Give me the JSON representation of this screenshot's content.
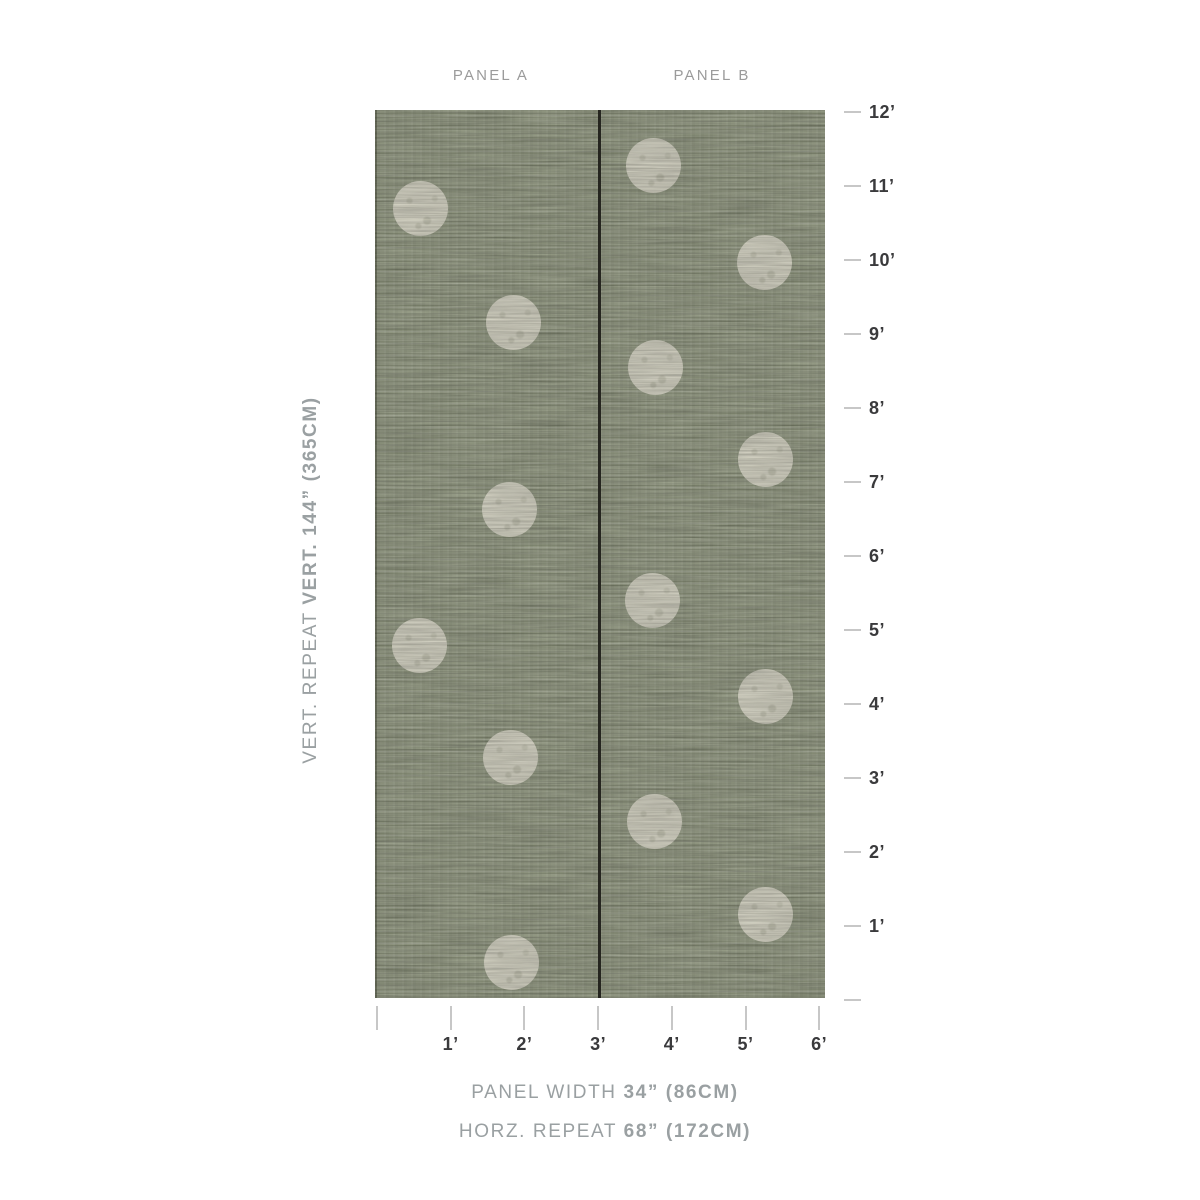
{
  "diagram": {
    "panel_a_label": "PANEL A",
    "panel_b_label": "PANEL B"
  },
  "annotations": {
    "vert_repeat_prefix": "VERT. REPEAT ",
    "vert_repeat_value": "VERT. 144” (365CM)",
    "panel_width_prefix": "PANEL WIDTH ",
    "panel_width_value": "34” (86CM)",
    "horz_repeat_prefix": "HORZ. REPEAT ",
    "horz_repeat_value": "68” (172CM)"
  },
  "rulers": {
    "vertical": {
      "unit": "feet",
      "labels": [
        "12’",
        "11’",
        "10’",
        "9’",
        "8’",
        "7’",
        "6’",
        "5’",
        "4’",
        "3’",
        "2’",
        "1’"
      ],
      "has_unlabeled_zero_tick": true
    },
    "horizontal": {
      "unit": "feet",
      "labels": [
        "1’",
        "2’",
        "3’",
        "4’",
        "5’",
        "6’"
      ],
      "has_unlabeled_zero_tick": true
    }
  },
  "swatch": {
    "description": "Two-panel sage grasscloth wallpaper with offset cream polka dots",
    "base_color": "#9aa287",
    "dot_color": "#e6e4d2",
    "divider_color": "#25251f",
    "dot_radius": 27.5,
    "dots_panel_a": [
      {
        "x": 45,
        "y": 98
      },
      {
        "x": 138,
        "y": 212
      },
      {
        "x": 134,
        "y": 399
      },
      {
        "x": 44,
        "y": 535
      },
      {
        "x": 135,
        "y": 647
      },
      {
        "x": 136,
        "y": 852
      }
    ],
    "dots_panel_b": [
      {
        "x": 278,
        "y": 55
      },
      {
        "x": 389,
        "y": 152
      },
      {
        "x": 280,
        "y": 257
      },
      {
        "x": 390,
        "y": 349
      },
      {
        "x": 277,
        "y": 490
      },
      {
        "x": 390,
        "y": 586
      },
      {
        "x": 279,
        "y": 711
      },
      {
        "x": 390,
        "y": 804
      }
    ]
  },
  "colors": {
    "page_bg": "#ffffff",
    "panel_label": "#9b9b9b",
    "ruler_label": "#3a3a3c",
    "tick": "#c7c7c7",
    "annotation_text": "#9aa0a2"
  }
}
